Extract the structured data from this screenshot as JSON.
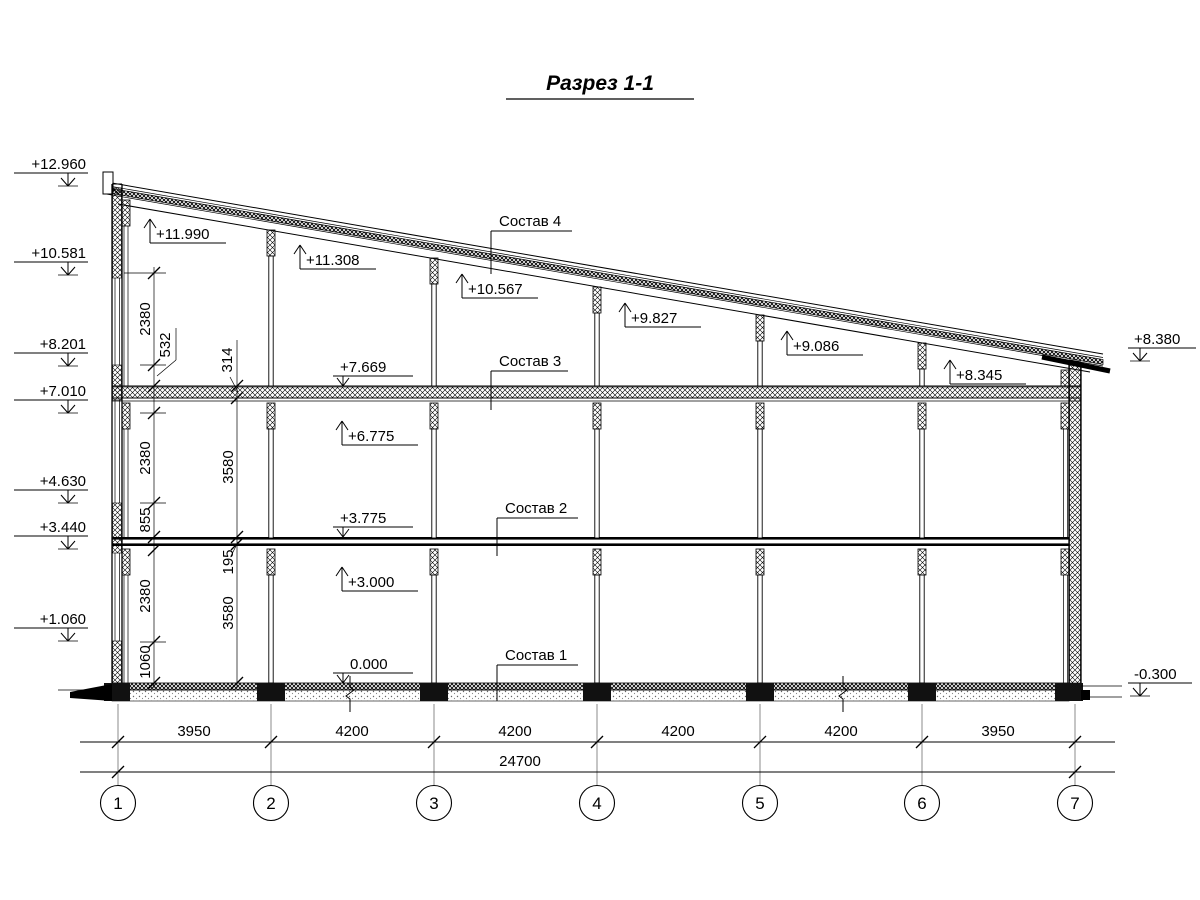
{
  "title": "Разрез 1-1",
  "marks": {
    "left": [
      "+12.960",
      "+10.581",
      "+8.201",
      "+7.010",
      "+4.630",
      "+3.440",
      "+1.060"
    ],
    "right": [
      "+8.380",
      "-0.300"
    ],
    "roof": [
      "+11.990",
      "+11.308",
      "+10.567",
      "+9.827",
      "+9.086",
      "+8.345"
    ],
    "interior": [
      "+7.669",
      "+6.775",
      "+3.775",
      "+3.000",
      "0.000"
    ]
  },
  "layers": [
    "Состав 4",
    "Состав 3",
    "Состав 2",
    "Состав 1"
  ],
  "dims": {
    "vertical_outer": [
      "2380",
      "532",
      "2380",
      "855",
      "2380",
      "1060"
    ],
    "vertical_inner": [
      "314",
      "3580",
      "195",
      "3580"
    ],
    "spans": [
      "3950",
      "4200",
      "4200",
      "4200",
      "4200",
      "3950"
    ],
    "total": "24700"
  },
  "axes": [
    "1",
    "2",
    "3",
    "4",
    "5",
    "6",
    "7"
  ]
}
